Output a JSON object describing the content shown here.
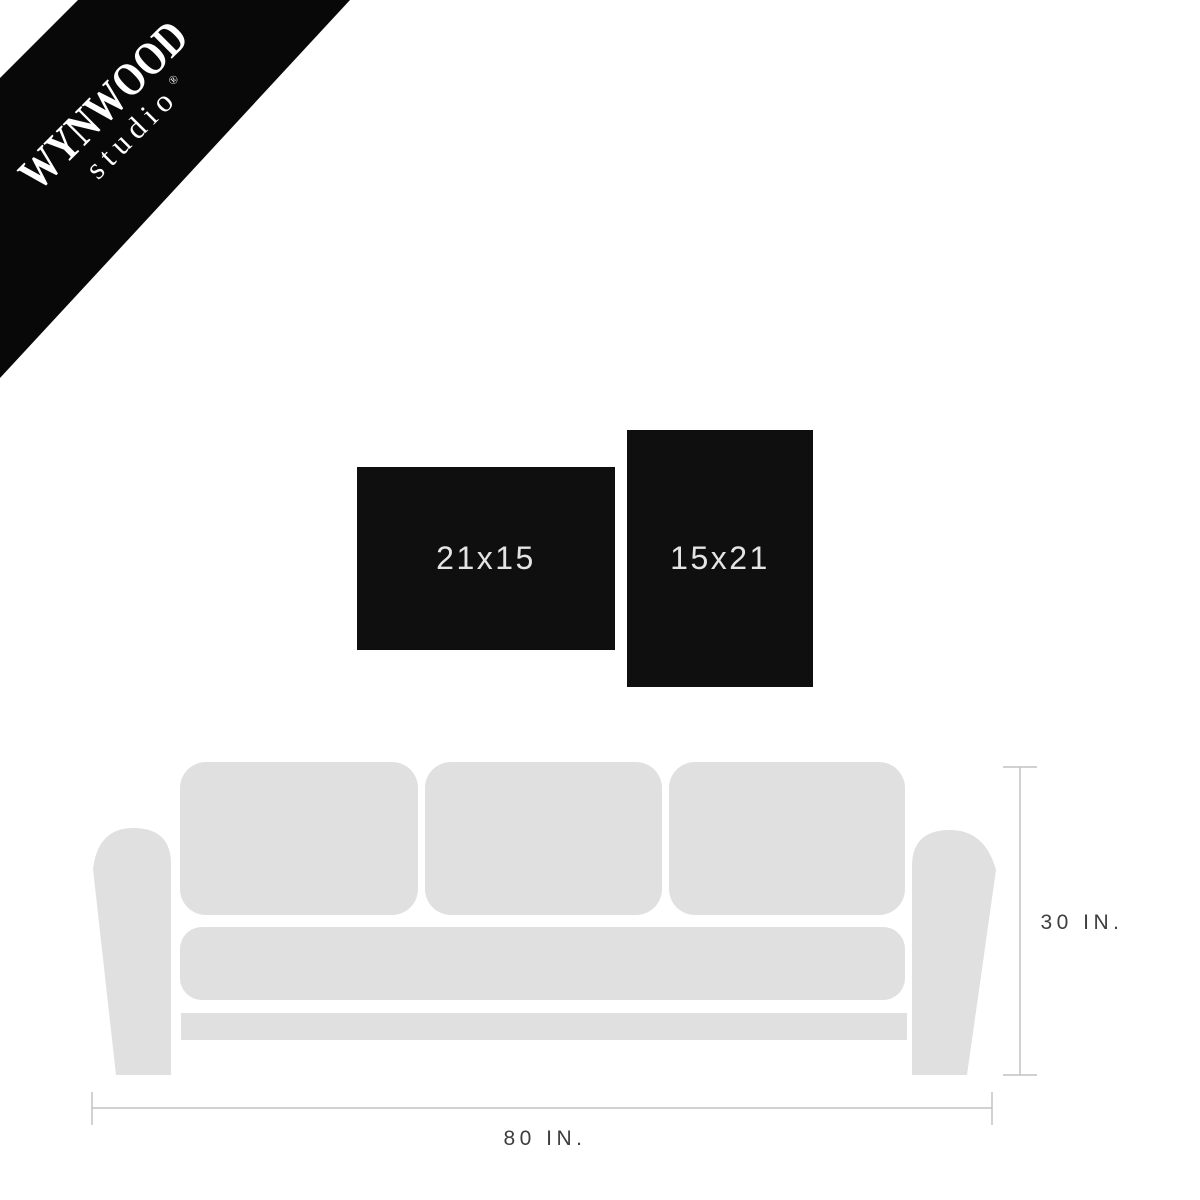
{
  "brand": {
    "name": "WYNWOOD",
    "sub": "studio",
    "reg": "®"
  },
  "frames": [
    {
      "label": "21x15",
      "orientation": "landscape"
    },
    {
      "label": "15x21",
      "orientation": "portrait"
    }
  ],
  "dimensions": {
    "width_label": "80 IN.",
    "height_label": "30 IN."
  },
  "colors": {
    "banner": "#080808",
    "frame": "#0f0f0f",
    "frame_text": "#e4e4e4",
    "couch": "#e0e0e0",
    "dim_line": "#c2c2c2",
    "dim_text": "#3e3e3e",
    "logo_text": "#ffffff"
  }
}
